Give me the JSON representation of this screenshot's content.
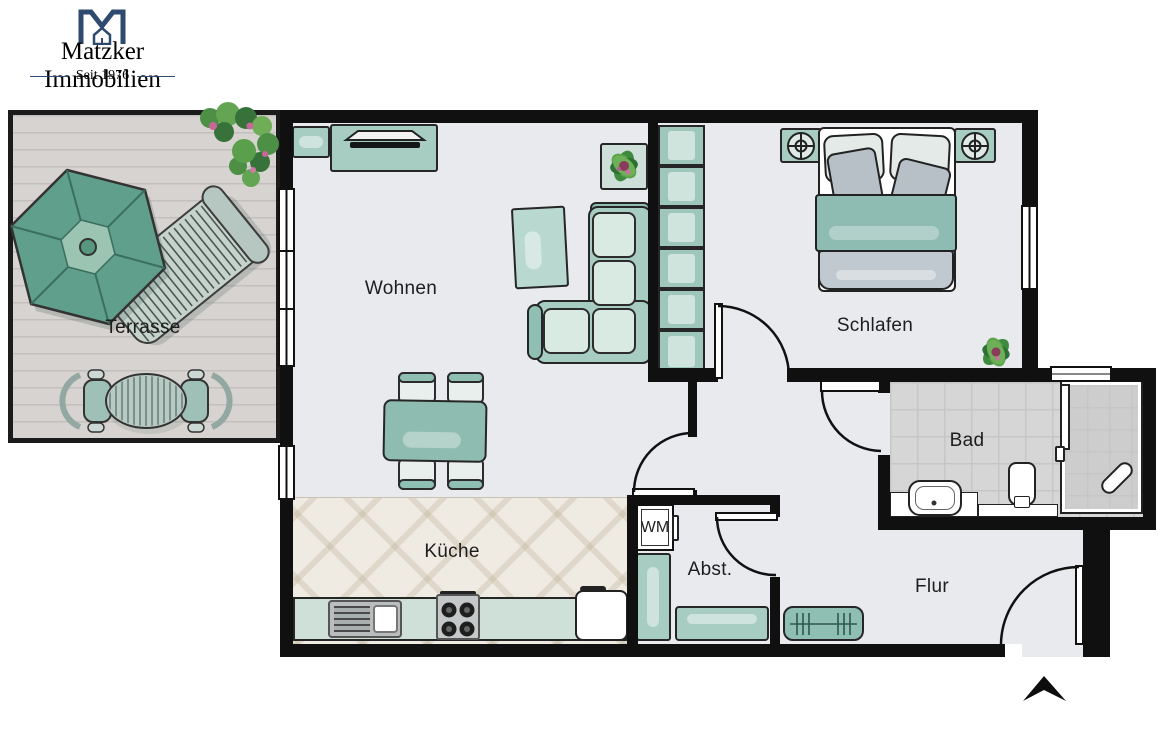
{
  "brand": {
    "name": "Matzker Immobilien",
    "tagline": "Seit 1976",
    "color": "#2e4a6e"
  },
  "rooms": {
    "terrasse": {
      "label": "Terrasse"
    },
    "wohnen": {
      "label": "Wohnen"
    },
    "schlafen": {
      "label": "Schlafen"
    },
    "kueche": {
      "label": "Küche"
    },
    "abstellraum": {
      "label": "Abst."
    },
    "bad": {
      "label": "Bad"
    },
    "flur": {
      "label": "Flur"
    }
  },
  "appliances": {
    "washing_machine": {
      "label": "WM"
    }
  },
  "icons": {
    "logo": "house-monogram-m-icon",
    "north_arrow": "north-arrow-icon",
    "lamps": "bedside-lamp-icon",
    "plants": "potted-plant-icon"
  },
  "colors": {
    "wall": "#101010",
    "floor": "#e8eaee",
    "furniture_teal": "#a7ccc2",
    "furniture_teal_light": "#d9eae3",
    "deck": "#d7d3d0",
    "kitchen_tile": "#efebe3",
    "bath_tile": "#d6d6d6",
    "parasol_green": "#5f9f8b",
    "brand_navy": "#2e4a6e"
  }
}
